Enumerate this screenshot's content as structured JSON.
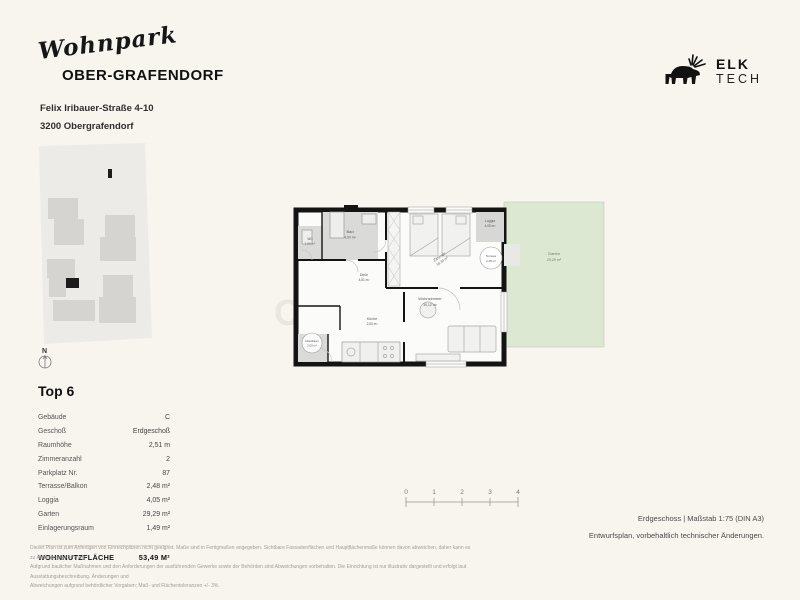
{
  "header": {
    "logo_script": "Wohnpark",
    "logo_main": "OBER-GRAFENDORF",
    "address_line1": "Felix Iribauer-Straße 4-10",
    "address_line2": "3200 Obergrafendorf"
  },
  "brand": {
    "name_top": "ELK",
    "name_bottom": "TECH"
  },
  "watermark": {
    "line1": "IMMO",
    "line2": "CONTRACT"
  },
  "site_plan": {
    "compass_label": "N"
  },
  "floor_plan": {
    "rooms": [
      {
        "name": "Bad",
        "area": "4,00 m²"
      },
      {
        "name": "WC",
        "area": "1,66 m²"
      },
      {
        "name": "Zimmer",
        "area": "10,30 m²"
      },
      {
        "name": "Diele",
        "area": "4,81 m²"
      },
      {
        "name": "Wohnzimmer",
        "area": "30,12 m²"
      },
      {
        "name": "Küche",
        "area": "2,60 m²"
      },
      {
        "name": "Abstellraum",
        "area": "2,00 m²"
      },
      {
        "name": "Loggia",
        "area": "4,05 m²"
      },
      {
        "name": "Terrasse",
        "area": "2,48 m²"
      },
      {
        "name": "Garten",
        "area": "29,29 m²"
      }
    ]
  },
  "unit": {
    "title": "Top 6",
    "rows": [
      {
        "label": "Gebäude",
        "value": "C"
      },
      {
        "label": "Geschoß",
        "value": "Erdgeschoß"
      },
      {
        "label": "Raumhöhe",
        "value": "2,51 m"
      },
      {
        "label": "Zimmeranzahl",
        "value": "2"
      },
      {
        "label": "Parkplatz Nr.",
        "value": "87"
      },
      {
        "label": "Terrasse/Balkon",
        "value": "2,48 m²"
      },
      {
        "label": "Loggia",
        "value": "4,05 m²"
      },
      {
        "label": "Garten",
        "value": "29,29 m²"
      },
      {
        "label": "Einlagerungsraum",
        "value": "1,49 m²"
      }
    ],
    "total_label": "WOHNNUTZFLÄCHE",
    "total_value": "53,49 M²"
  },
  "scale_bar": {
    "ticks": [
      "0",
      "1",
      "2",
      "3",
      "4"
    ]
  },
  "footer": {
    "plan_info": "Erdgeschoss | Maßstab 1:75 (DIN A3)",
    "note": "Entwurfsplan, vorbehaltlich technischer Änderungen.",
    "disclaimer_line1": "Dieser Plan ist zum Anfertigen von Einreichplänen nicht geeignet. Maße sind in Fertigmaßen angegeben. Sichtbare Fassadenflächen und Hauptflächenmaße können davon abweichen, daher kann es zu Änderungen kommen.",
    "disclaimer_line2": "Aufgrund baulicher Maßnahmen und den Anforderungen der ausführenden Gewerke sowie der Behörden sind Abweichungen vorbehalten. Die Einrichtung ist nur illustrativ dargestellt und erfolgt laut Ausstattungsbeschreibung. Änderungen und",
    "disclaimer_line3": "Abweichungen aufgrund behördlicher Vorgaben; Maß- und Flächentoleranzen +/- 3%."
  },
  "colors": {
    "background": "#f8f5ef",
    "wall": "#141414",
    "room_gray": "#dadad8",
    "garden_green": "#dce8d1",
    "site_parcel": "#edebe7",
    "site_building": "#d5d4d0",
    "highlight_unit": "#1c1c1c"
  }
}
